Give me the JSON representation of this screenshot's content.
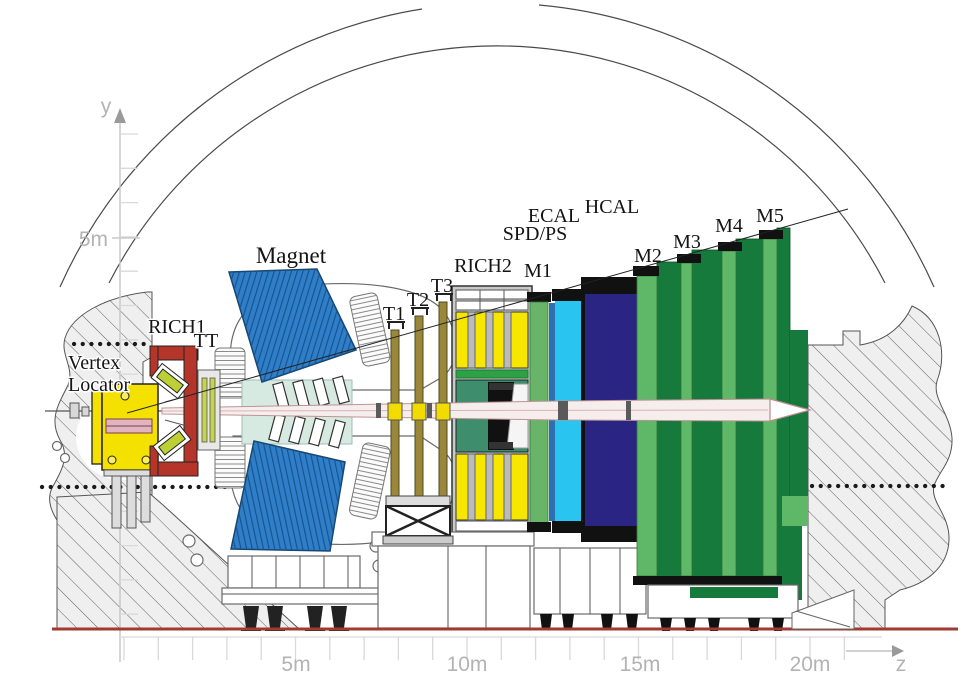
{
  "labels": {
    "vertex1": "Vertex",
    "vertex2": "Locator",
    "rich1": "RICH1",
    "tt": "TT",
    "magnet": "Magnet",
    "t1": "T1",
    "t2": "T2",
    "t3": "T3",
    "rich2": "RICH2",
    "m1": "M1",
    "spdps": "SPD/PS",
    "ecal": "ECAL",
    "hcal": "HCAL",
    "m2": "M2",
    "m3": "M3",
    "m4": "M4",
    "m5": "M5"
  },
  "axes": {
    "y_label": "y",
    "y_5m": "5m",
    "z_label": "z",
    "z_5m": "5m",
    "z_10m": "10m",
    "z_15m": "15m",
    "z_20m": "20m"
  },
  "colors": {
    "magnet_blue": "#2F7EC7",
    "magnet_teal": "#D6EAE2",
    "velo_yellow": "#F5E100",
    "velo_pink": "#E2B4C0",
    "rich1_red": "#B5352B",
    "mirror_green": "#BCCF35",
    "tt_green": "#C4D44E",
    "t_olive": "#9A8838",
    "t_yellow": "#F2DC00",
    "rich2_gray": "#C9C9C9",
    "rich2_yellow": "#F7E600",
    "rich2_teal": "#3E8E6E",
    "green_strip": "#2EA045",
    "m1_green": "#68B56A",
    "spd_blue": "#2E6FB2",
    "ecal_cyan": "#2AC4F0",
    "hcal_navy": "#2A2483",
    "muon_light": "#5FB768",
    "muon_dark": "#157A3C",
    "floor_red": "#A03A32",
    "axis_gray": "#C9C9C9",
    "black": "#111111"
  }
}
